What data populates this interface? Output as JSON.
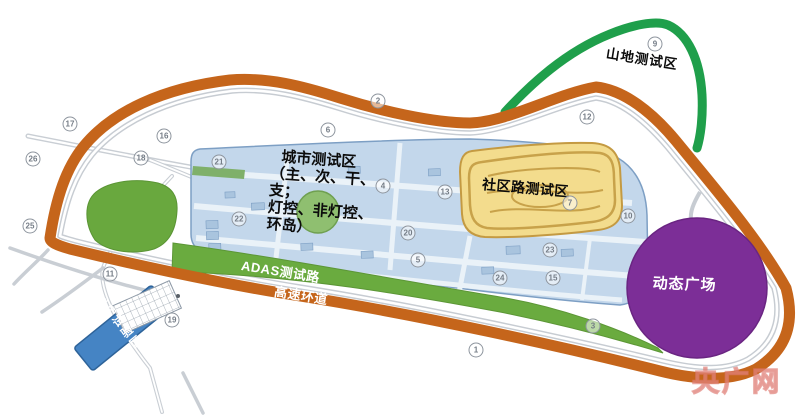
{
  "map_title": "智能网联汽车测试场地平面图",
  "areas": {
    "mountain": {
      "label": "山地测试区",
      "track_color": "#1f9f4b"
    },
    "urban": {
      "label": "城市测试区（主、次、干、支；灯控、非灯控、环岛）",
      "lines": [
        "城市测试区",
        "（主、次、干、",
        "支；",
        "灯控、非灯控、",
        "环岛）"
      ],
      "fill": "#c3d7eb",
      "border": "#7d9fc4"
    },
    "community": {
      "label": "社区路测试区",
      "fill": "#f3dc8d",
      "border": "#c49a42"
    },
    "plaza": {
      "label": "动态广场",
      "fill": "#7c2e97"
    },
    "adas": {
      "label": "ADAS测试路",
      "fill": "#6aab3f"
    },
    "highway": {
      "label": "高速环道",
      "track_color": "#c5651b"
    },
    "indoor": {
      "label": "室内试验区",
      "fill": "#4584c4"
    },
    "green_zone": {
      "fill": "#69a83e"
    }
  },
  "markers": [
    {
      "x": 70,
      "y": 124,
      "n": "17"
    },
    {
      "x": 33,
      "y": 159,
      "n": "26"
    },
    {
      "x": 30,
      "y": 226,
      "n": "25"
    },
    {
      "x": 110,
      "y": 274,
      "n": "11"
    },
    {
      "x": 164,
      "y": 136,
      "n": "16"
    },
    {
      "x": 141,
      "y": 158,
      "n": "18"
    },
    {
      "x": 219,
      "y": 162,
      "n": "21"
    },
    {
      "x": 239,
      "y": 219,
      "n": "22"
    },
    {
      "x": 378,
      "y": 101,
      "n": "2"
    },
    {
      "x": 328,
      "y": 130,
      "n": "6"
    },
    {
      "x": 587,
      "y": 117,
      "n": "12"
    },
    {
      "x": 655,
      "y": 44,
      "n": "9"
    },
    {
      "x": 383,
      "y": 186,
      "n": "4"
    },
    {
      "x": 445,
      "y": 192,
      "n": "13"
    },
    {
      "x": 408,
      "y": 233,
      "n": "20"
    },
    {
      "x": 418,
      "y": 260,
      "n": "5"
    },
    {
      "x": 550,
      "y": 250,
      "n": "23"
    },
    {
      "x": 500,
      "y": 278,
      "n": "24"
    },
    {
      "x": 553,
      "y": 278,
      "n": "15"
    },
    {
      "x": 570,
      "y": 203,
      "n": "7"
    },
    {
      "x": 628,
      "y": 216,
      "n": "10"
    },
    {
      "x": 476,
      "y": 350,
      "n": "1"
    },
    {
      "x": 172,
      "y": 320,
      "n": "19"
    },
    {
      "x": 593,
      "y": 326,
      "n": "3"
    }
  ],
  "watermark": {
    "text": "央广网",
    "color": "#de766e"
  }
}
